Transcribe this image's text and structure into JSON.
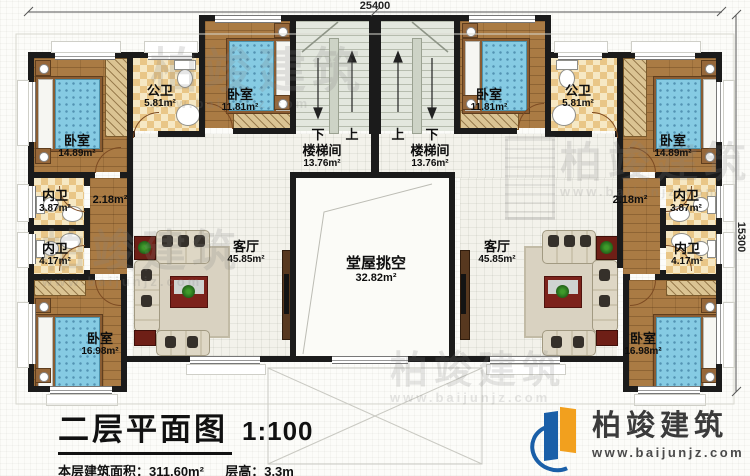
{
  "dimensions": {
    "width_top": "25400",
    "height_right": "15300"
  },
  "rooms": {
    "bedroom_large": {
      "name": "卧室",
      "area": "14.89m²"
    },
    "bath_public": {
      "name": "公卫",
      "area": "5.81m²"
    },
    "bedroom_small": {
      "name": "卧室",
      "area": "11.81m²"
    },
    "staircase": {
      "name": "楼梯间",
      "area": "13.76m²"
    },
    "bath_inner_small": {
      "name": "内卫",
      "area": "3.87m²"
    },
    "bath_inner_large": {
      "name": "内卫",
      "area": "4.17m²"
    },
    "corridor": {
      "area": "2.18m²"
    },
    "living": {
      "name": "客厅",
      "area": "45.85m²"
    },
    "hall_void": {
      "name": "堂屋挑空",
      "area": "32.82m²"
    },
    "bedroom_bottom": {
      "name": "卧室",
      "area": "16.98m²"
    }
  },
  "stairs": {
    "down": "下",
    "up": "上"
  },
  "title_block": {
    "title": "二层平面图",
    "scale": "1:100",
    "floor_area_label": "本层建筑面积：",
    "floor_area": "311.60m²",
    "height_label": "层高：",
    "floor_height": "3.3m"
  },
  "brand": {
    "name": "柏竣建筑",
    "website": "www.baijunjz.com"
  }
}
